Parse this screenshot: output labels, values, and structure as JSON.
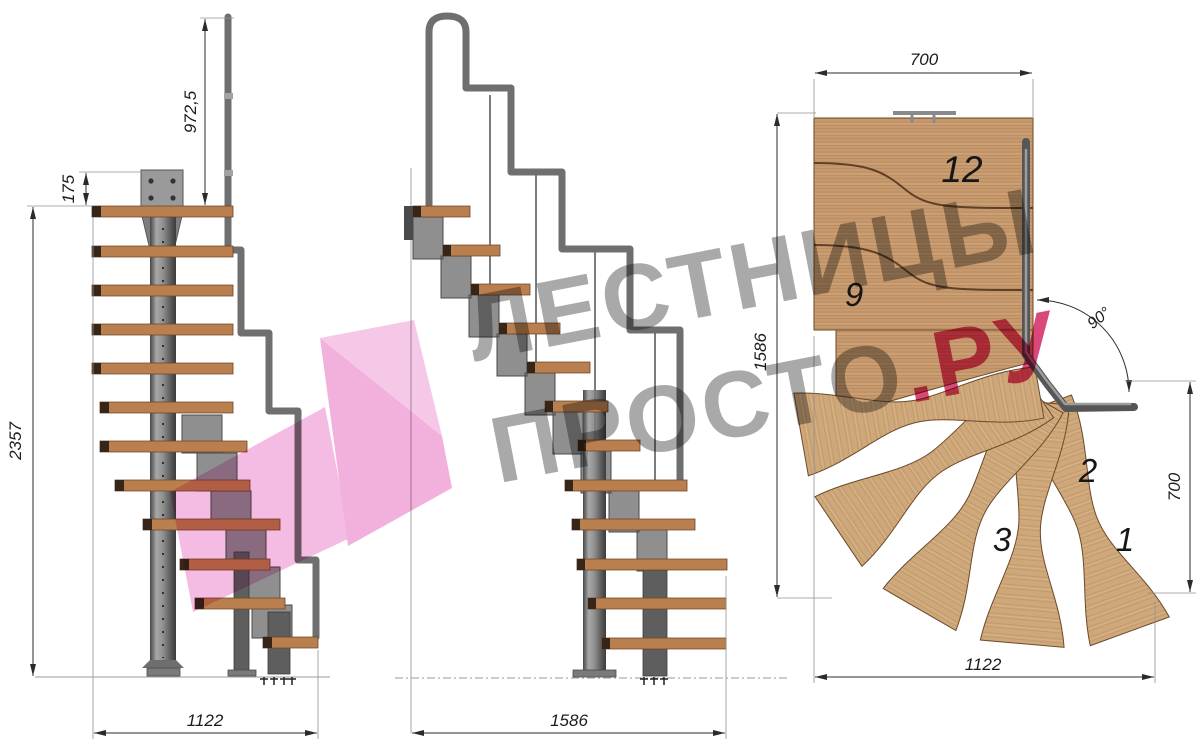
{
  "canvas": {
    "background": "#ffffff"
  },
  "views": {
    "front_elevation": {
      "name": "Front elevation",
      "dimensions": {
        "handrail_height": "972,5",
        "top_mount_offset": "175",
        "total_height": "2357",
        "flight_width": "1122"
      }
    },
    "side_elevation": {
      "name": "Side elevation",
      "dimensions": {
        "total_run": "1586"
      }
    },
    "plan_view": {
      "name": "Plan view",
      "dimensions": {
        "upper_flight_width": "700",
        "total_depth": "1586",
        "lower_flight_depth": "700",
        "total_width": "1122",
        "turn_angle": "90°"
      },
      "step_labels": {
        "step_12": "12",
        "step_9": "9",
        "step_3": "3",
        "step_2": "2",
        "step_1": "1"
      }
    }
  },
  "watermark": {
    "line1": "ЛЕСТНИЦЫ",
    "line2_main": "ПРОСТО",
    "line2_accent": ".РУ",
    "text_color": "#a9a9a9",
    "accent_color": "#d8487a",
    "arrow_fold_color": "#f6c8e8",
    "arrow_head_color": "#f2b1dd",
    "arrow_tail_color": "#f4bce2"
  }
}
